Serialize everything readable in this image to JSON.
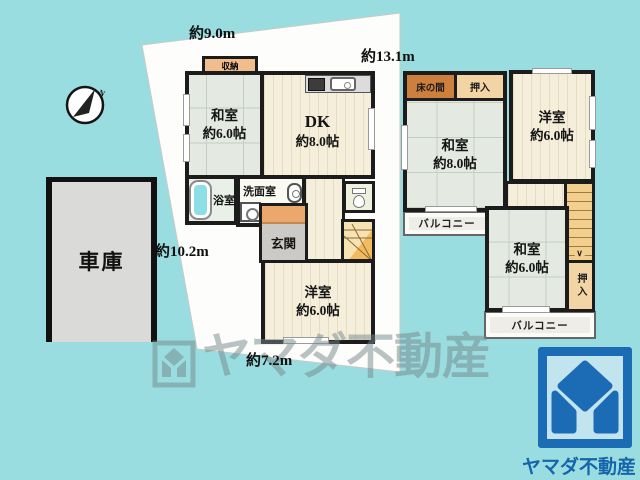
{
  "colors": {
    "background_teal": "#9adde0",
    "brand_blue": "#1b6cb5",
    "wall_black": "#1c1c1c",
    "tatami_green": "#e4eae1",
    "flooring_cream": "#f5eedb"
  },
  "compass": {
    "north": "N"
  },
  "dimensions": {
    "top": "約9.0m",
    "right": "約13.1m",
    "left": "約10.2m",
    "bottom": "約7.2m"
  },
  "garage": {
    "label": "車庫"
  },
  "floor1": {
    "storage_label": "収納",
    "washitsu": {
      "name": "和室",
      "size": "約6.0帖"
    },
    "dk": {
      "name": "DK",
      "size": "約8.0帖"
    },
    "bath_label": "浴室",
    "washroom_label": "洗面室",
    "entrance_label": "玄関",
    "yoshitsu": {
      "name": "洋室",
      "size": "約6.0帖"
    }
  },
  "floor2": {
    "tokonoma_label": "床の間",
    "closet_top_label": "押入",
    "washitsu8": {
      "name": "和室",
      "size": "約8.0帖"
    },
    "yoshitsu": {
      "name": "洋室",
      "size": "約6.0帖"
    },
    "balcony_left_label": "バルコニー",
    "washitsu6": {
      "name": "和室",
      "size": "約6.0帖"
    },
    "closet_right_label": "押入",
    "balcony_bottom_label": "バルコニー"
  },
  "icons": {
    "stairs_down_arrow": "∨"
  },
  "watermark": {
    "text": "ヤマダ不動産"
  },
  "brand": {
    "name": "ヤマダ不動産"
  }
}
